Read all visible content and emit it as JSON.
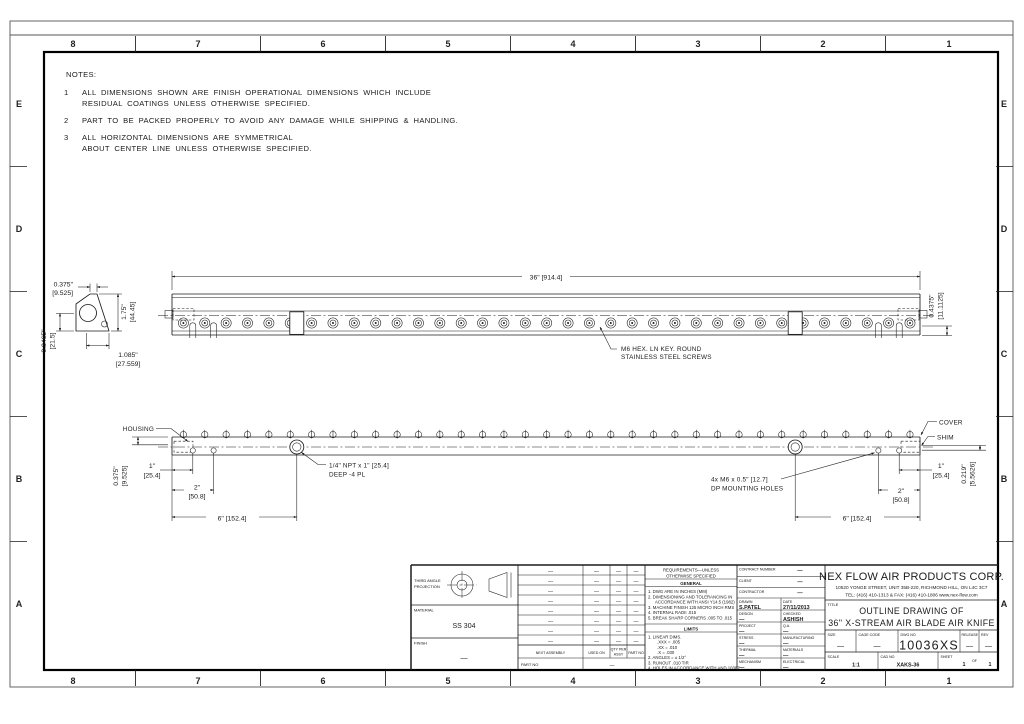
{
  "zones": {
    "columns": [
      "8",
      "7",
      "6",
      "5",
      "4",
      "3",
      "2",
      "1"
    ],
    "rows": [
      "E",
      "D",
      "C",
      "B",
      "A"
    ]
  },
  "notes": {
    "title": "NOTES:",
    "items": [
      {
        "num": "1",
        "line1": "ALL DIMENSIONS SHOWN ARE FINISH OPERATIONAL DIMENSIONS WHICH INCLUDE",
        "line2": "RESIDUAL COATINGS UNLESS OTHERWISE SPECIFIED."
      },
      {
        "num": "2",
        "line1": "PART TO BE PACKED PROPERLY TO AVOID ANY DAMAGE WHILE SHIPPING & HANDLING.",
        "line2": ""
      },
      {
        "num": "3",
        "line1": "ALL HORIZONTAL DIMENSIONS ARE SYMMETRICAL",
        "line2": "ABOUT CENTER LINE UNLESS OTHERWISE SPECIFIED."
      }
    ]
  },
  "front_view": {
    "dim_length": "36\" [914.4]",
    "dim_height_in": "0.4375\"",
    "dim_height_mm": "[11.1125]",
    "screw_callout_line1": "M6 HEX. LN KEY. ROUND",
    "screw_callout_line2": "STAINLESS STEEL SCREWS"
  },
  "end_view": {
    "dim_top_in": "0.375\"",
    "dim_top_mm": "[9.525]",
    "dim_right_in": "1.75\"",
    "dim_right_mm": "[44.45]",
    "dim_left_in": "0.8465\"",
    "dim_left_mm": "[21.5]",
    "dim_bottom_in": "1.085\"",
    "dim_bottom_mm": "[27.559]"
  },
  "bottom_view": {
    "label_housing": "HOUSING",
    "label_cover": "COVER",
    "label_shim": "SHIM",
    "dim_left_in": "0.375\"",
    "dim_left_mm": "[9.525]",
    "dim_right_in": "0.219\"",
    "dim_right_mm": "[5.5626]",
    "dim_1_in": "1\"",
    "dim_1_mm": "[25.4]",
    "dim_2_in": "2\"",
    "dim_2_mm": "[50.8]",
    "dim_6": "6\" [152.4]",
    "npt_callout_line1": "1/4\" NPT x 1\" [25.4]",
    "npt_callout_line2": "DEEP -4 PL",
    "mounting_callout_line1": "4x M6 x 0.5\" [12.7]",
    "mounting_callout_line2": "DP MOUNTING HOLES"
  },
  "title_block": {
    "projection_line1": "THIRD ANGLE",
    "projection_line2": "PROJECTION",
    "material_label": "MATERIAL",
    "material_value": "SS 304",
    "finish_label": "FINISH",
    "finish_value": "—",
    "parts_table": {
      "headers": [
        "NEXT ASSEMBLY",
        "USED ON",
        "QTY PER",
        "ASSY",
        "PART NO"
      ],
      "rows": [
        [
          "—",
          "—",
          "—",
          "—"
        ],
        [
          "—",
          "—",
          "—",
          "—"
        ],
        [
          "—",
          "—",
          "—",
          "—"
        ],
        [
          "—",
          "—",
          "—",
          "—"
        ],
        [
          "—",
          "—",
          "—",
          "—"
        ],
        [
          "—",
          "—",
          "—",
          "—"
        ],
        [
          "—",
          "—",
          "—",
          "—"
        ],
        [
          "—",
          "—",
          "—",
          "—"
        ]
      ],
      "part_no_label": "PART NO",
      "part_no_value": "—"
    },
    "requirements": {
      "header_line1": "REQUIREMENTS—UNLESS",
      "header_line2": "OTHERWISE SPECIFIED",
      "general_title": "GENERAL",
      "general_items": [
        {
          "text": "1. DWG ARE IN INCHES (MM)",
          "indent": 0
        },
        {
          "text": "2. DIMENSIONING AND TOLERANCING IN",
          "indent": 0
        },
        {
          "text": "ACCORDANCE WITH ANSI Y14.5 (1982)",
          "indent": 1
        },
        {
          "text": "3. MACHINE FINISH 125 MICRO INCH RMS",
          "indent": 0
        },
        {
          "text": "4. INTERNAL RADII .015",
          "indent": 0
        },
        {
          "text": "5. BREAK SHARP CORNERS .005 TO .015",
          "indent": 0
        }
      ],
      "limits_title": "LIMITS",
      "limits_items": [
        {
          "text": "1. LINEAR DIMS.",
          "indent": 0
        },
        {
          "text": ".XXX = .005",
          "indent": 1
        },
        {
          "text": ".XX = .010",
          "indent": 1
        },
        {
          "text": ".X = .030",
          "indent": 1
        },
        {
          "text": "2. ANGLES = ± 1/2°",
          "indent": 0
        },
        {
          "text": "3. RUNOUT .010 TIR",
          "indent": 0
        },
        {
          "text": "4. HOLES IN ACCORDANCE WITH AND 10387",
          "indent": 0
        }
      ]
    },
    "signoff": {
      "contract_label": "CONTRACT NUMBER",
      "contract_value": "—",
      "client_label": "CLIENT",
      "client_value": "—",
      "contractor_label": "CONTRACTOR",
      "contractor_value": "—",
      "rows": [
        {
          "l1": "DRAWN",
          "v1": "S.PATEL",
          "l2": "DATE",
          "v2": "27/11/2013"
        },
        {
          "l1": "DESIGN",
          "v1": "—",
          "l2": "CHECKED",
          "v2": "ASHISH"
        },
        {
          "l1": "PROJECT",
          "v1": "—",
          "l2": "Q.A.",
          "v2": "—"
        },
        {
          "l1": "STRESS",
          "v1": "—",
          "l2": "MANUFACTURING",
          "v2": "—"
        },
        {
          "l1": "THERMAL",
          "v1": "—",
          "l2": "MATERIALS",
          "v2": "—"
        },
        {
          "l1": "MECHANISM",
          "v1": "—",
          "l2": "ELECTRICAL",
          "v2": "—"
        }
      ]
    },
    "company": {
      "name": "NEX FLOW AIR PRODUCTS CORP.",
      "address_line1": "10520 YONGE STREET, UNIT 35B-220, RICHMOND HILL, ON L4C 3C7",
      "address_line2": "TEL: (416) 410-1313 & FAX: (416) 410-1806 www.nex-flow.com",
      "title_label": "TITLE",
      "drawing_title_line1": "OUTLINE DRAWING OF",
      "drawing_title_line2": "36\" X-STREAM AIR BLADE AIR KNIFE",
      "size_label": "SIZE",
      "size_value": "—",
      "cage_label": "CAGE CODE",
      "cage_value": "—",
      "dwg_label": "DWG NO",
      "dwg_value": "10036XS",
      "release_label": "RELEASE",
      "release_value": "—",
      "rev_label": "REV",
      "rev_value": "—",
      "scale_label": "SCALE",
      "scale_value": "1:1",
      "cad_label": "CAD NO",
      "cad_value": "XAKS-36",
      "sheet_label": "SHEET",
      "sheet_value": "1",
      "of_label": "OF",
      "of_value": "1"
    }
  }
}
